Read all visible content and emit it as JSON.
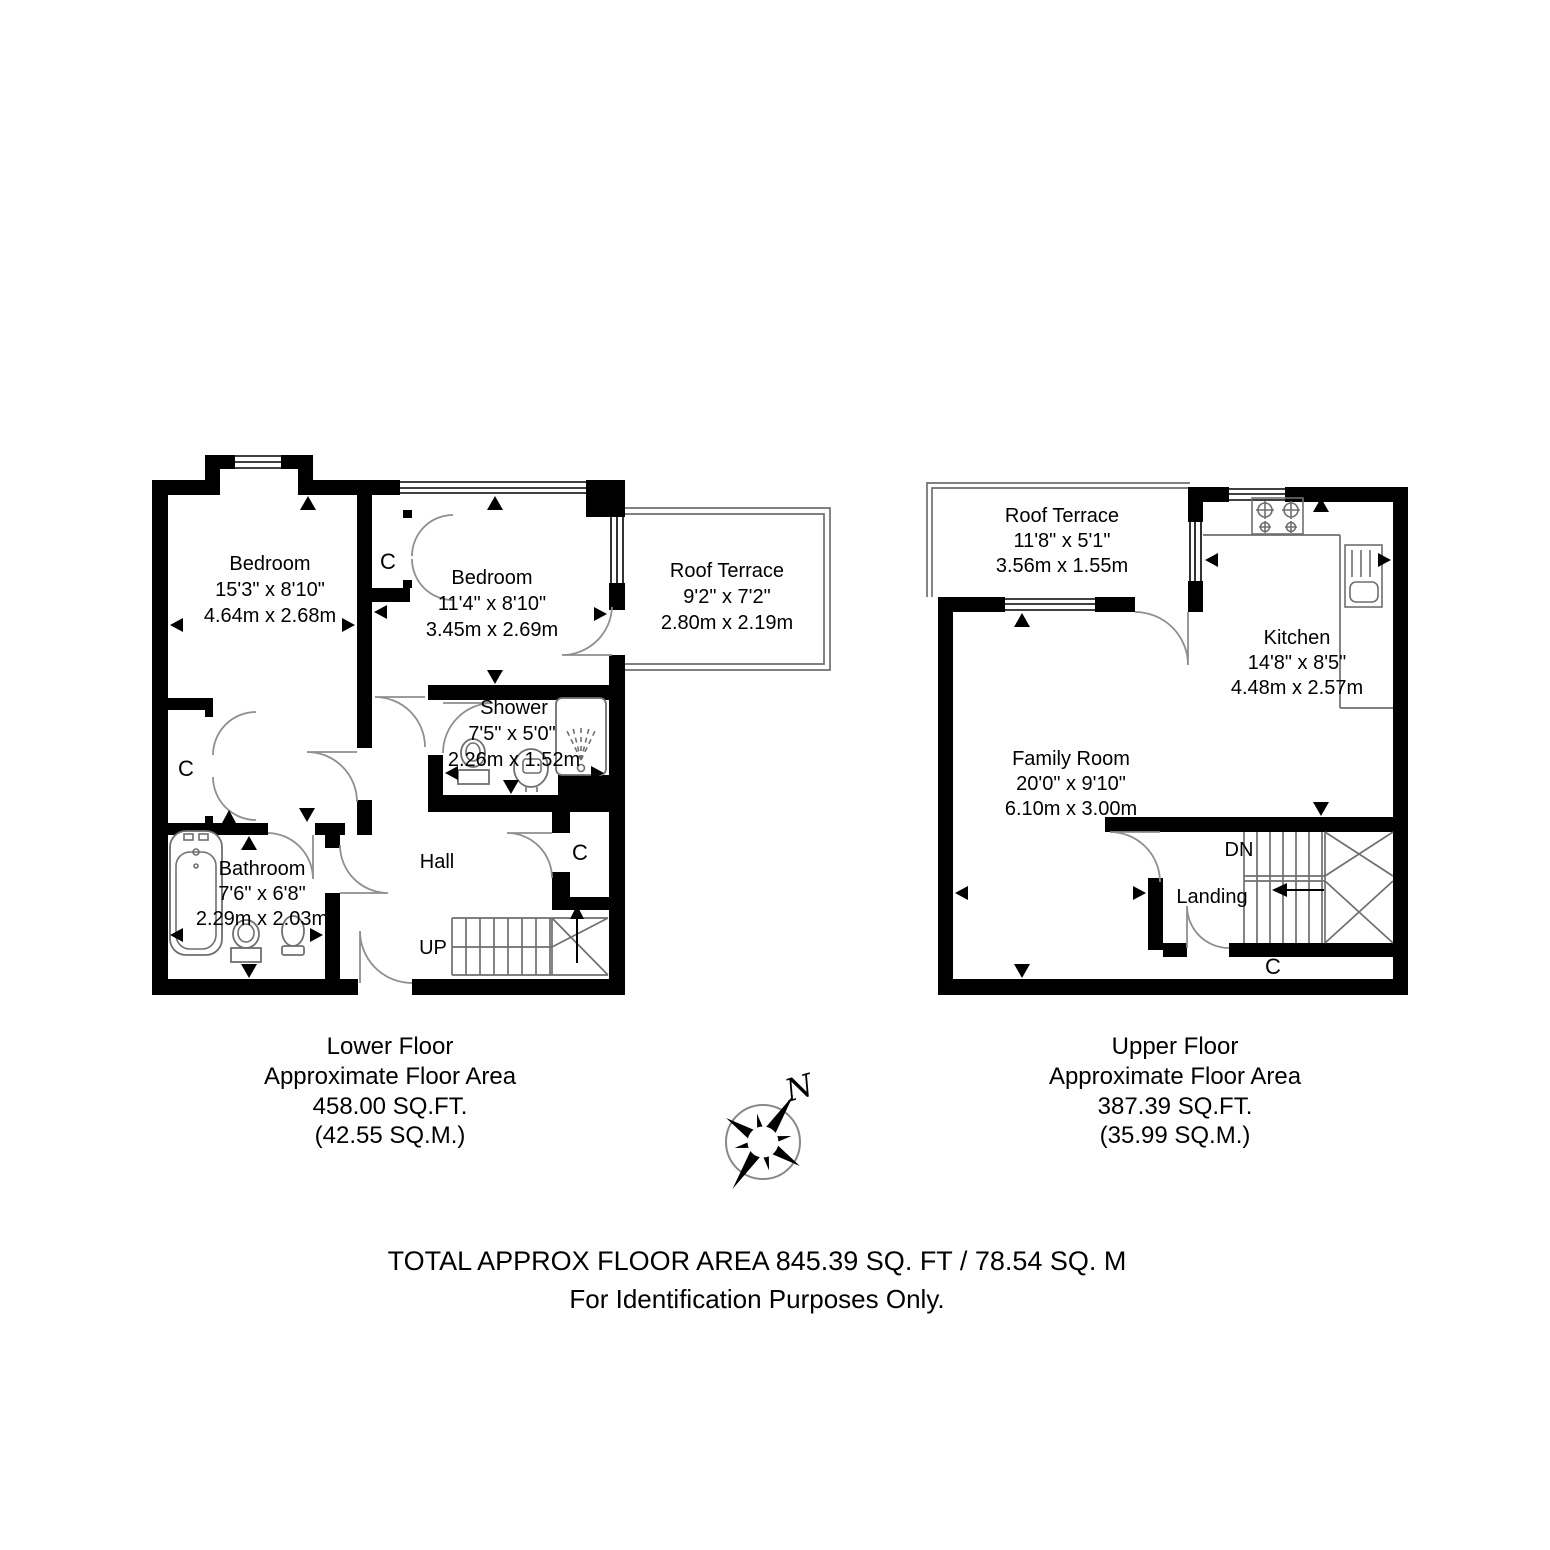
{
  "footer": {
    "total_line": "TOTAL APPROX FLOOR AREA 845.39 SQ. FT / 78.54 SQ. M",
    "purpose_line": "For Identification Purposes Only."
  },
  "compass": {
    "north_label": "N"
  },
  "lower_floor": {
    "caption": {
      "title": "Lower Floor",
      "line2": "Approximate Floor Area",
      "line3": "458.00 SQ.FT.",
      "line4": "(42.55 SQ.M.)"
    },
    "rooms": {
      "bedroom1": {
        "name": "Bedroom",
        "imperial": "15'3\" x 8'10\"",
        "metric": "4.64m x 2.68m"
      },
      "bedroom2": {
        "name": "Bedroom",
        "imperial": "11'4\" x 8'10\"",
        "metric": "3.45m x 2.69m"
      },
      "roof_terrace": {
        "name": "Roof Terrace",
        "imperial": "9'2\" x 7'2\"",
        "metric": "2.80m x 2.19m"
      },
      "shower": {
        "name": "Shower",
        "imperial": "7'5\" x 5'0\"",
        "metric": "2.26m x 1.52m"
      },
      "bathroom": {
        "name": "Bathroom",
        "imperial": "7'6\" x 6'8\"",
        "metric": "2.29m x 2.03m"
      },
      "hall": {
        "name": "Hall"
      },
      "closet_left": {
        "label": "C"
      },
      "closet_middle": {
        "label": "C"
      },
      "closet_hall": {
        "label": "C"
      },
      "stairs": {
        "label": "UP"
      }
    }
  },
  "upper_floor": {
    "caption": {
      "title": "Upper Floor",
      "line2": "Approximate Floor Area",
      "line3": "387.39 SQ.FT.",
      "line4": "(35.99 SQ.M.)"
    },
    "rooms": {
      "roof_terrace": {
        "name": "Roof Terrace",
        "imperial": "11'8\" x 5'1\"",
        "metric": "3.56m x 1.55m"
      },
      "kitchen": {
        "name": "Kitchen",
        "imperial": "14'8\" x 8'5\"",
        "metric": "4.48m x 2.57m"
      },
      "family_room": {
        "name": "Family Room",
        "imperial": "20'0\" x 9'10\"",
        "metric": "6.10m x 3.00m"
      },
      "landing": {
        "name": "Landing"
      },
      "stairs": {
        "label": "DN"
      },
      "closet": {
        "label": "C"
      }
    }
  },
  "colors": {
    "wall": "#000000",
    "line": "#6f6f6f",
    "background": "#ffffff"
  }
}
